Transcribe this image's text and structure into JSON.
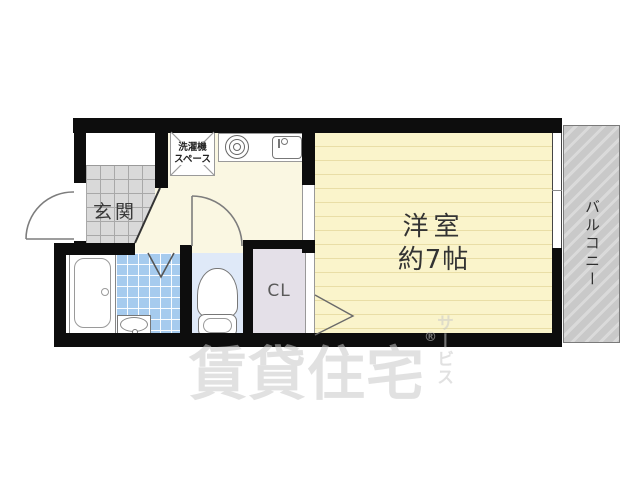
{
  "floorplan": {
    "entrance": {
      "label": "玄関"
    },
    "laundry": {
      "line1": "洗濯機",
      "line2": "スペース"
    },
    "main_room": {
      "line1": "洋室",
      "line2": "約7帖"
    },
    "closet": {
      "label": "CL"
    },
    "balcony": {
      "label": "バルコニー"
    },
    "colors": {
      "wall": "#0d0d0d",
      "room_floor": "#faf4cb",
      "hall_floor": "#faf7e2",
      "entrance_tile": "#d9d9d9",
      "bath_tile": "#a6cbee",
      "toilet_floor": "#dfe9f8",
      "closet_floor": "#e4e0e8",
      "balcony_hatch": "#c9c9c9"
    }
  },
  "watermark": {
    "main": "賃貸住宅",
    "sub": "サービス",
    "mark": "®"
  }
}
